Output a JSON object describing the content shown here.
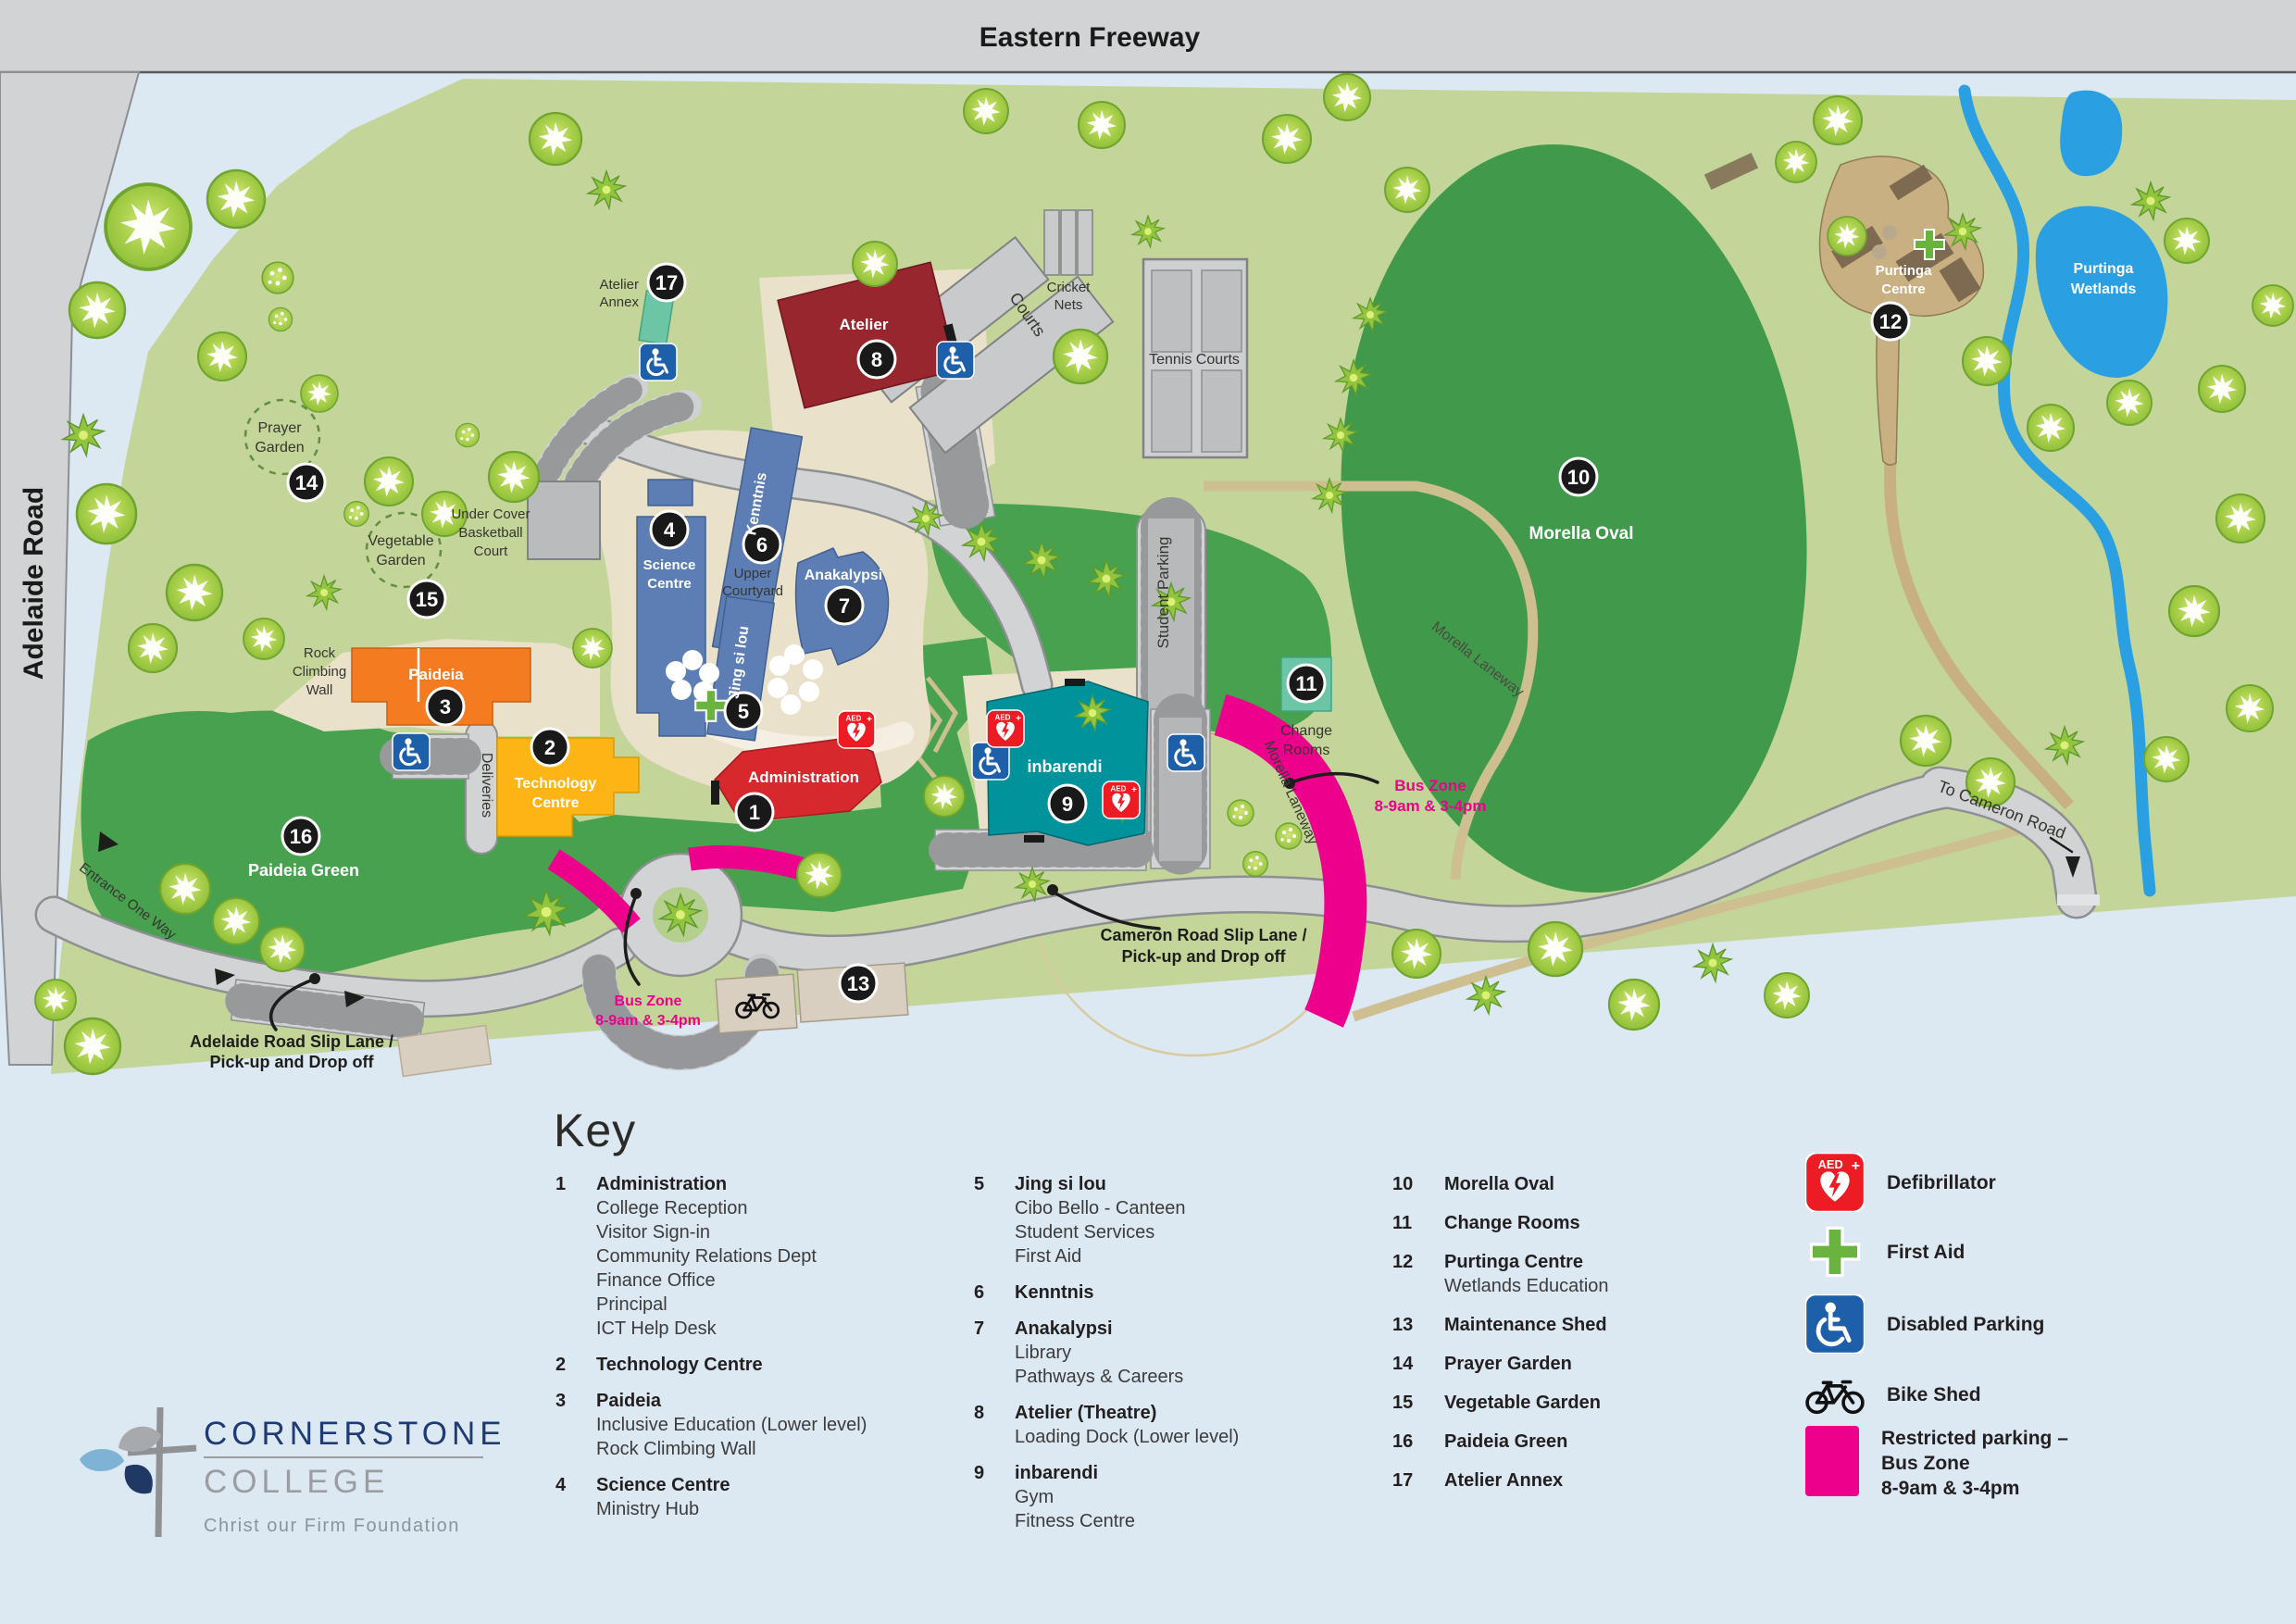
{
  "map": {
    "roads": {
      "eastern_freeway": "Eastern Freeway",
      "adelaide_road": "Adelaide Road",
      "to_cameron_road": "To Cameron Road",
      "entrance_one_way": "Entrance One Way",
      "deliveries": "Deliveries",
      "student_parking": "Student Parking",
      "morella_laneway": "Morella Laneway",
      "courts": "Courts"
    },
    "places": {
      "prayer_garden_l1": "Prayer",
      "prayer_garden_l2": "Garden",
      "vegetable_garden_l1": "Vegetable",
      "vegetable_garden_l2": "Garden",
      "basketball_l1": "Under Cover",
      "basketball_l2": "Basketball",
      "basketball_l3": "Court",
      "rock_wall_l1": "Rock",
      "rock_wall_l2": "Climbing",
      "rock_wall_l3": "Wall",
      "upper_courtyard_l1": "Upper",
      "upper_courtyard_l2": "Courtyard",
      "cricket_l1": "Cricket",
      "cricket_l2": "Nets",
      "tennis_courts": "Tennis Courts",
      "morella_oval": "Morella Oval",
      "change_rooms_l1": "Change",
      "change_rooms_l2": "Rooms",
      "paideia_green": "Paideia Green",
      "purtinga_centre_l1": "Purtinga",
      "purtinga_centre_l2": "Centre",
      "purtinga_wetlands_l1": "Purtinga",
      "purtinga_wetlands_l2": "Wetlands"
    },
    "buildings": {
      "administration": "Administration",
      "technology_l1": "Technology",
      "technology_l2": "Centre",
      "paideia": "Paideia",
      "science_l1": "Science",
      "science_l2": "Centre",
      "kenntnis": "Kenntnis",
      "jing_si_lou": "Jing si lou",
      "anakalypsi": "Anakalypsi",
      "atelier": "Atelier",
      "atelier_annex_l1": "Atelier",
      "atelier_annex_l2": "Annex",
      "inbarendi": "inbarendi"
    },
    "annotations": {
      "bus_zone_l1": "Bus Zone",
      "bus_zone_l2": "8-9am & 3-4pm",
      "cameron_slip_l1": "Cameron Road Slip Lane /",
      "cameron_slip_l2": "Pick-up and Drop off",
      "adelaide_slip_l1": "Adelaide Road Slip Lane /",
      "adelaide_slip_l2": "Pick-up and Drop off"
    },
    "markers": {
      "m1": "1",
      "m2": "2",
      "m3": "3",
      "m4": "4",
      "m5": "5",
      "m6": "6",
      "m7": "7",
      "m8": "8",
      "m9": "9",
      "m10": "10",
      "m11": "11",
      "m12": "12",
      "m13": "13",
      "m14": "14",
      "m15": "15",
      "m16": "16",
      "m17": "17"
    }
  },
  "key": {
    "heading": "Key",
    "aed_text": "AED",
    "col1": [
      {
        "num": "1",
        "name": "Administration",
        "sub": [
          "College Reception",
          "Visitor Sign-in",
          "Community Relations Dept",
          "Finance Office",
          "Principal",
          "ICT Help Desk"
        ]
      },
      {
        "num": "2",
        "name": "Technology Centre",
        "sub": []
      },
      {
        "num": "3",
        "name": "Paideia",
        "sub": [
          "Inclusive Education (Lower level)",
          "Rock Climbing Wall"
        ]
      },
      {
        "num": "4",
        "name": "Science Centre",
        "sub": [
          "Ministry Hub"
        ]
      }
    ],
    "col2": [
      {
        "num": "5",
        "name": "Jing si lou",
        "sub": [
          "Cibo Bello - Canteen",
          "Student Services",
          "First Aid"
        ]
      },
      {
        "num": "6",
        "name": "Kenntnis",
        "sub": []
      },
      {
        "num": "7",
        "name": "Anakalypsi",
        "sub": [
          "Library",
          "Pathways & Careers"
        ]
      },
      {
        "num": "8",
        "name": "Atelier (Theatre)",
        "sub": [
          "Loading Dock (Lower level)"
        ]
      },
      {
        "num": "9",
        "name": "inbarendi",
        "sub": [
          "Gym",
          "Fitness Centre"
        ]
      }
    ],
    "col3": [
      {
        "num": "10",
        "name": "Morella Oval",
        "sub": []
      },
      {
        "num": "11",
        "name": "Change Rooms",
        "sub": []
      },
      {
        "num": "12",
        "name": "Purtinga Centre",
        "sub": [
          "Wetlands Education"
        ]
      },
      {
        "num": "13",
        "name": "Maintenance Shed",
        "sub": []
      },
      {
        "num": "14",
        "name": "Prayer Garden",
        "sub": []
      },
      {
        "num": "15",
        "name": "Vegetable Garden",
        "sub": []
      },
      {
        "num": "16",
        "name": "Paideia Green",
        "sub": []
      },
      {
        "num": "17",
        "name": "Atelier Annex",
        "sub": []
      }
    ],
    "legend": [
      {
        "icon": "defibrillator-icon",
        "l1": "Defibrillator"
      },
      {
        "icon": "first-aid-icon",
        "l1": "First Aid"
      },
      {
        "icon": "disabled-parking-icon",
        "l1": "Disabled Parking"
      },
      {
        "icon": "bike-shed-icon",
        "l1": "Bike Shed"
      },
      {
        "icon": "bus-zone-swatch",
        "l1": "Restricted parking –",
        "l2": "Bus Zone",
        "l3": "8-9am & 3-4pm"
      }
    ]
  },
  "logo": {
    "name_l1": "CORNERSTONE",
    "name_l2": "COLLEGE",
    "tagline": "Christ our Firm Foundation"
  },
  "colors": {
    "bus_zone": "#ec008c",
    "building_blue": "#5c7eb5",
    "admin_red": "#d7282e",
    "atelier_maroon": "#97262f",
    "paideia_orange": "#f47b20",
    "technology_amber": "#fcb514",
    "inbarendi_teal": "#00939b",
    "annex_teal": "#6cc6a5",
    "lawn_green": "#47a14e",
    "campus_green": "#c4d59a",
    "water_blue": "#2a9fe1",
    "first_aid_green": "#6ab33e",
    "disabled_blue": "#1d5fa8",
    "aed_red": "#ed1c24"
  }
}
